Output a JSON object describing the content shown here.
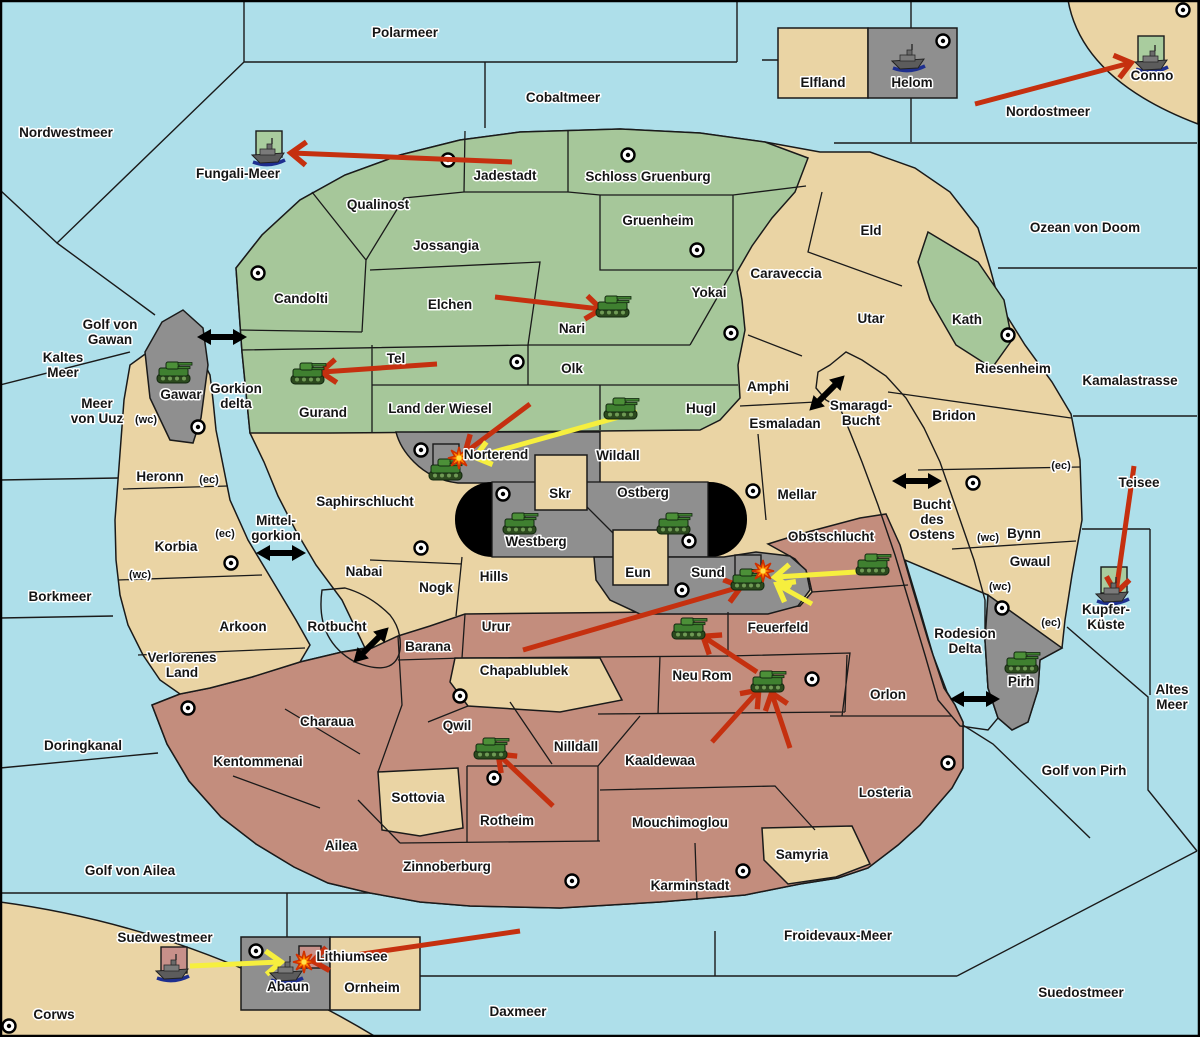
{
  "map": {
    "colors": {
      "sea": "#AEDFEA",
      "land_tan": "#EAD4A4",
      "land_green": "#A6C79A",
      "land_red": "#C38D7D",
      "land_gray": "#8F8F8F",
      "capsule_black": "#000000",
      "attack_red": "#C5300F",
      "attack_yellow": "#F6EF3E",
      "unit_square_green": "#A9CC9E",
      "unit_square_pink": "#C8908A"
    },
    "labels": [
      {
        "id": "polarmeer",
        "t": "Polarmeer",
        "x": 405,
        "y": 37
      },
      {
        "id": "cobaltmeer",
        "t": "Cobaltmeer",
        "x": 563,
        "y": 102
      },
      {
        "id": "nordwestmeer",
        "t": "Nordwestmeer",
        "x": 66,
        "y": 137
      },
      {
        "id": "fungali-meer",
        "t": "Fungali-Meer",
        "x": 238,
        "y": 178
      },
      {
        "id": "nordostmeer",
        "t": "Nordostmeer",
        "x": 1048,
        "y": 116
      },
      {
        "id": "ozean-von-doom",
        "t": "Ozean von Doom",
        "x": 1085,
        "y": 232
      },
      {
        "id": "kaltes-meer",
        "lines": [
          "Kaltes",
          "Meer"
        ],
        "x": 63,
        "y": 362
      },
      {
        "id": "meer-von-uuz",
        "lines": [
          "Meer",
          "von Uuz"
        ],
        "x": 97,
        "y": 408
      },
      {
        "id": "golf-von-gawan",
        "lines": [
          "Golf von",
          "Gawan"
        ],
        "x": 110,
        "y": 329
      },
      {
        "id": "gorkion-delta",
        "lines": [
          "Gorkion",
          "delta"
        ],
        "x": 236,
        "y": 393
      },
      {
        "id": "kamalastrasse",
        "t": "Kamalastrasse",
        "x": 1130,
        "y": 385
      },
      {
        "id": "smaragd-bucht",
        "lines": [
          "Smaragd-",
          "Bucht"
        ],
        "x": 861,
        "y": 410
      },
      {
        "id": "bucht-des-ostens",
        "lines": [
          "Bucht",
          "des",
          "Ostens"
        ],
        "x": 932,
        "y": 509
      },
      {
        "id": "teisee",
        "t": "Teisee",
        "x": 1139,
        "y": 487
      },
      {
        "id": "borkmeer",
        "t": "Borkmeer",
        "x": 60,
        "y": 601
      },
      {
        "id": "mittel-gorkion",
        "lines": [
          "Mittel-",
          "gorkion"
        ],
        "x": 276,
        "y": 525
      },
      {
        "id": "rotbucht",
        "t": "Rotbucht",
        "x": 337,
        "y": 631
      },
      {
        "id": "doringkanal",
        "t": "Doringkanal",
        "x": 83,
        "y": 750
      },
      {
        "id": "golf-von-ailea",
        "t": "Golf von Ailea",
        "x": 130,
        "y": 875
      },
      {
        "id": "suedwestmeer",
        "t": "Suedwestmeer",
        "x": 165,
        "y": 942
      },
      {
        "id": "corws",
        "t": "Corws",
        "x": 54,
        "y": 1019
      },
      {
        "id": "lithiumsee",
        "t": "Lithiumsee",
        "x": 352,
        "y": 961
      },
      {
        "id": "daxmeer",
        "t": "Daxmeer",
        "x": 518,
        "y": 1016
      },
      {
        "id": "froidevaux-meer",
        "t": "Froidevaux-Meer",
        "x": 838,
        "y": 940
      },
      {
        "id": "suedostmeer",
        "t": "Suedostmeer",
        "x": 1081,
        "y": 997
      },
      {
        "id": "golf-von-pirh",
        "t": "Golf von Pirh",
        "x": 1084,
        "y": 775
      },
      {
        "id": "altes-meer",
        "lines": [
          "Altes",
          "Meer"
        ],
        "x": 1172,
        "y": 694
      },
      {
        "id": "rodesion-delta",
        "lines": [
          "Rodesion",
          "Delta"
        ],
        "x": 965,
        "y": 638
      },
      {
        "id": "qualinost",
        "t": "Qualinost",
        "x": 378,
        "y": 209
      },
      {
        "id": "j adestadt",
        "t": "Jadestadt",
        "x": 505,
        "y": 180
      },
      {
        "id": "schloss-gruenburg",
        "t": "Schloss Gruenburg",
        "x": 648,
        "y": 181
      },
      {
        "id": "jossangia",
        "t": "Jossangia",
        "x": 446,
        "y": 250
      },
      {
        "id": "gruenheim",
        "t": "Gruenheim",
        "x": 658,
        "y": 225
      },
      {
        "id": "yokai",
        "t": "Yokai",
        "x": 709,
        "y": 297
      },
      {
        "id": "candolti",
        "t": "Candolti",
        "x": 301,
        "y": 303
      },
      {
        "id": "elchen",
        "t": "Elchen",
        "x": 450,
        "y": 309
      },
      {
        "id": "nari",
        "t": "Nari",
        "x": 572,
        "y": 333
      },
      {
        "id": "tel",
        "t": "Tel",
        "x": 396,
        "y": 363
      },
      {
        "id": "olk",
        "t": "Olk",
        "x": 572,
        "y": 373
      },
      {
        "id": "gurand",
        "t": "Gurand",
        "x": 323,
        "y": 417
      },
      {
        "id": "land-der-wiesel",
        "t": "Land der Wiesel",
        "x": 440,
        "y": 413
      },
      {
        "id": "hugl",
        "t": "Hugl",
        "x": 701,
        "y": 413
      },
      {
        "id": "amphi",
        "t": "Amphi",
        "x": 768,
        "y": 391
      },
      {
        "id": "esmaladan",
        "t": "Esmaladan",
        "x": 785,
        "y": 428
      },
      {
        "id": "eld",
        "t": "Eld",
        "x": 871,
        "y": 235
      },
      {
        "id": "utar",
        "t": "Utar",
        "x": 871,
        "y": 323
      },
      {
        "id": "kath",
        "t": "Kath",
        "x": 967,
        "y": 324
      },
      {
        "id": "caraveccia",
        "t": "Caraveccia",
        "x": 786,
        "y": 278
      },
      {
        "id": "riesenheim",
        "t": "Riesenheim",
        "x": 1013,
        "y": 373
      },
      {
        "id": "bridon",
        "t": "Bridon",
        "x": 954,
        "y": 420
      },
      {
        "id": "bynn",
        "t": "Bynn",
        "x": 1024,
        "y": 538
      },
      {
        "id": "gwaul",
        "t": "Gwaul",
        "x": 1030,
        "y": 566
      },
      {
        "id": "mellar",
        "t": "Mellar",
        "x": 797,
        "y": 499
      },
      {
        "id": "wildall",
        "t": "Wildall",
        "x": 618,
        "y": 460
      },
      {
        "id": "norterend",
        "t": "Norterend",
        "x": 496,
        "y": 459
      },
      {
        "id": "skr",
        "t": "Skr",
        "x": 560,
        "y": 498
      },
      {
        "id": "ostberg",
        "t": "Ostberg",
        "x": 643,
        "y": 497
      },
      {
        "id": "westberg",
        "t": "Westberg",
        "x": 536,
        "y": 546
      },
      {
        "id": "eun",
        "t": "Eun",
        "x": 638,
        "y": 577
      },
      {
        "id": "sund",
        "t": "Sund",
        "x": 708,
        "y": 577
      },
      {
        "id": "hills",
        "t": "Hills",
        "x": 494,
        "y": 581
      },
      {
        "id": "nogk",
        "t": "Nogk",
        "x": 436,
        "y": 592
      },
      {
        "id": "nabai",
        "t": "Nabai",
        "x": 364,
        "y": 576
      },
      {
        "id": "saphirschlucht",
        "t": "Saphirschlucht",
        "x": 365,
        "y": 506
      },
      {
        "id": "heronn",
        "t": "Heronn",
        "x": 160,
        "y": 481
      },
      {
        "id": "korbia",
        "t": "Korbia",
        "x": 176,
        "y": 551
      },
      {
        "id": "arkoon",
        "t": "Arkoon",
        "x": 243,
        "y": 631
      },
      {
        "id": "verlorenes-land",
        "lines": [
          "Verlorenes",
          "Land"
        ],
        "x": 182,
        "y": 662
      },
      {
        "id": "urur",
        "t": "Urur",
        "x": 496,
        "y": 631
      },
      {
        "id": "barana",
        "t": "Barana",
        "x": 428,
        "y": 651
      },
      {
        "id": "chapablublek",
        "t": "Chapablublek",
        "x": 524,
        "y": 675
      },
      {
        "id": "feuerfeld",
        "t": "Feuerfeld",
        "x": 778,
        "y": 632
      },
      {
        "id": "neu-rom",
        "t": "Neu Rom",
        "x": 702,
        "y": 680
      },
      {
        "id": "obstschlucht",
        "t": "Obstschlucht",
        "x": 831,
        "y": 541
      },
      {
        "id": "orlon",
        "t": "Orlon",
        "x": 888,
        "y": 699
      },
      {
        "id": "losteria",
        "t": "Losteria",
        "x": 885,
        "y": 797
      },
      {
        "id": "samyria",
        "t": "Samyria",
        "x": 802,
        "y": 859
      },
      {
        "id": "karminstadt",
        "t": "Karminstadt",
        "x": 690,
        "y": 890
      },
      {
        "id": "zinnoberburg",
        "t": "Zinnoberburg",
        "x": 447,
        "y": 871
      },
      {
        "id": "ailea",
        "t": "Ailea",
        "x": 341,
        "y": 850
      },
      {
        "id": "charaua",
        "t": "Charaua",
        "x": 327,
        "y": 726
      },
      {
        "id": "kentommenai",
        "t": "Kentommenai",
        "x": 258,
        "y": 766
      },
      {
        "id": "sottovia",
        "t": "Sottovia",
        "x": 418,
        "y": 802
      },
      {
        "id": "qwil",
        "t": "Qwil",
        "x": 457,
        "y": 730
      },
      {
        "id": "nilldall",
        "t": "Nilldall",
        "x": 576,
        "y": 751
      },
      {
        "id": "kaaldewaa",
        "t": "Kaaldewaa",
        "x": 660,
        "y": 765
      },
      {
        "id": "rotheim",
        "t": "Rotheim",
        "x": 507,
        "y": 825
      },
      {
        "id": "mouchimoglou",
        "t": "Mouchimoglou",
        "x": 680,
        "y": 827
      },
      {
        "id": "elfland",
        "t": "Elfland",
        "x": 823,
        "y": 87
      },
      {
        "id": "helom",
        "t": "Helom",
        "x": 912,
        "y": 87
      },
      {
        "id": "conno",
        "t": "Conno",
        "x": 1152,
        "y": 80
      },
      {
        "id": "abaun",
        "t": "Abaun",
        "x": 288,
        "y": 991
      },
      {
        "id": "ornheim",
        "t": "Ornheim",
        "x": 372,
        "y": 992
      },
      {
        "id": "pirh",
        "t": "Pirh",
        "x": 1021,
        "y": 686
      },
      {
        "id": "kupfer-kueste",
        "lines": [
          "Kupfer-",
          "Küste"
        ],
        "x": 1106,
        "y": 614
      },
      {
        "id": "gawar",
        "t": "Gawar",
        "x": 181,
        "y": 399
      }
    ],
    "badges": [
      {
        "t": "(wc)",
        "x": 146,
        "y": 419
      },
      {
        "t": "(ec)",
        "x": 209,
        "y": 479
      },
      {
        "t": "(ec)",
        "x": 225,
        "y": 533
      },
      {
        "t": "(wc)",
        "x": 140,
        "y": 574
      },
      {
        "t": "(wc)",
        "x": 988,
        "y": 537
      },
      {
        "t": "(ec)",
        "x": 1061,
        "y": 465
      },
      {
        "t": "(wc)",
        "x": 1000,
        "y": 586
      },
      {
        "t": "(ec)",
        "x": 1051,
        "y": 622
      }
    ],
    "capitals": [
      {
        "x": 258,
        "y": 273
      },
      {
        "x": 448,
        "y": 160
      },
      {
        "x": 628,
        "y": 155
      },
      {
        "x": 697,
        "y": 250
      },
      {
        "x": 731,
        "y": 333
      },
      {
        "x": 943,
        "y": 41
      },
      {
        "x": 1183,
        "y": 10
      },
      {
        "x": 1008,
        "y": 335
      },
      {
        "x": 198,
        "y": 427
      },
      {
        "x": 231,
        "y": 563
      },
      {
        "x": 517,
        "y": 362
      },
      {
        "x": 421,
        "y": 450
      },
      {
        "x": 503,
        "y": 494
      },
      {
        "x": 689,
        "y": 541
      },
      {
        "x": 753,
        "y": 491
      },
      {
        "x": 973,
        "y": 483
      },
      {
        "x": 1002,
        "y": 608
      },
      {
        "x": 682,
        "y": 590
      },
      {
        "x": 812,
        "y": 679
      },
      {
        "x": 948,
        "y": 763
      },
      {
        "x": 188,
        "y": 708
      },
      {
        "x": 460,
        "y": 696
      },
      {
        "x": 494,
        "y": 778
      },
      {
        "x": 572,
        "y": 881
      },
      {
        "x": 743,
        "y": 871
      },
      {
        "x": 9,
        "y": 1026
      },
      {
        "x": 256,
        "y": 951
      },
      {
        "x": 421,
        "y": 548
      }
    ],
    "units": [
      {
        "type": "tank",
        "region": "nari",
        "x": 613,
        "y": 307
      },
      {
        "type": "tank",
        "region": "gurand",
        "x": 308,
        "y": 374
      },
      {
        "type": "tank",
        "region": "gawar",
        "x": 174,
        "y": 373
      },
      {
        "type": "tank",
        "region": "hugl",
        "x": 621,
        "y": 409
      },
      {
        "type": "tank",
        "region": "norterend",
        "x": 446,
        "y": 470
      },
      {
        "type": "tank",
        "region": "westberg",
        "x": 520,
        "y": 524
      },
      {
        "type": "tank",
        "region": "ostberg",
        "x": 674,
        "y": 524
      },
      {
        "type": "tank",
        "region": "sund",
        "x": 748,
        "y": 580
      },
      {
        "type": "tank",
        "region": "obstschlucht",
        "x": 873,
        "y": 565
      },
      {
        "type": "tank",
        "region": "feuerfeld",
        "x": 689,
        "y": 629
      },
      {
        "type": "tank",
        "region": "neu-rom",
        "x": 768,
        "y": 682
      },
      {
        "type": "tank",
        "region": "qwil",
        "x": 491,
        "y": 749
      },
      {
        "type": "tank",
        "region": "pirh",
        "x": 1022,
        "y": 663
      },
      {
        "type": "ship",
        "region": "fungali-meer",
        "x": 269,
        "y": 153
      },
      {
        "type": "ship",
        "region": "helom",
        "x": 909,
        "y": 59
      },
      {
        "type": "ship",
        "region": "conno",
        "x": 1152,
        "y": 60
      },
      {
        "type": "ship",
        "region": "kupfer-kueste",
        "x": 1113,
        "y": 592
      },
      {
        "type": "ship",
        "region": "suedwestmeer",
        "x": 173,
        "y": 969
      },
      {
        "type": "ship",
        "region": "abaun",
        "x": 287,
        "y": 971
      }
    ],
    "unit_squares": [
      {
        "x": 256,
        "y": 131,
        "s": 26,
        "fill": "green"
      },
      {
        "x": 1138,
        "y": 36,
        "s": 26,
        "fill": "green"
      },
      {
        "x": 1101,
        "y": 567,
        "s": 26,
        "fill": "green"
      },
      {
        "x": 161,
        "y": 947,
        "s": 26,
        "fill": "pink"
      },
      {
        "x": 299,
        "y": 946,
        "s": 22,
        "fill": "pink"
      },
      {
        "x": 433,
        "y": 444,
        "s": 26,
        "fill": "none"
      },
      {
        "x": 735,
        "y": 555,
        "s": 26,
        "fill": "none"
      }
    ],
    "explosions": [
      {
        "x": 459,
        "y": 458
      },
      {
        "x": 763,
        "y": 571
      },
      {
        "x": 304,
        "y": 962
      }
    ],
    "straits": [
      {
        "x": 222,
        "y": 337,
        "r": 0
      },
      {
        "x": 281,
        "y": 553,
        "r": 0
      },
      {
        "x": 371,
        "y": 645,
        "r": -45
      },
      {
        "x": 827,
        "y": 393,
        "r": -45
      },
      {
        "x": 917,
        "y": 481,
        "r": 0
      },
      {
        "x": 975,
        "y": 699,
        "r": 0
      }
    ],
    "attacks": [
      {
        "c": "red",
        "x1": 512,
        "y1": 162,
        "x2": 292,
        "y2": 153
      },
      {
        "c": "red",
        "x1": 975,
        "y1": 104,
        "x2": 1130,
        "y2": 63
      },
      {
        "c": "red",
        "x1": 495,
        "y1": 297,
        "x2": 600,
        "y2": 309
      },
      {
        "c": "red",
        "x1": 437,
        "y1": 364,
        "x2": 322,
        "y2": 372
      },
      {
        "c": "red",
        "x1": 530,
        "y1": 404,
        "x2": 466,
        "y2": 452
      },
      {
        "c": "red",
        "x1": 523,
        "y1": 650,
        "x2": 740,
        "y2": 587
      },
      {
        "c": "red",
        "x1": 757,
        "y1": 672,
        "x2": 704,
        "y2": 637
      },
      {
        "c": "red",
        "x1": 712,
        "y1": 742,
        "x2": 758,
        "y2": 691
      },
      {
        "c": "red",
        "x1": 790,
        "y1": 748,
        "x2": 772,
        "y2": 694
      },
      {
        "c": "red",
        "x1": 553,
        "y1": 806,
        "x2": 499,
        "y2": 755
      },
      {
        "c": "red",
        "x1": 1134,
        "y1": 466,
        "x2": 1116,
        "y2": 592
      },
      {
        "c": "red",
        "x1": 520,
        "y1": 931,
        "x2": 314,
        "y2": 961
      },
      {
        "c": "yellow",
        "x1": 637,
        "y1": 412,
        "x2": 476,
        "y2": 457
      },
      {
        "c": "yellow",
        "x1": 856,
        "y1": 572,
        "x2": 776,
        "y2": 577
      },
      {
        "c": "yellow",
        "x1": 812,
        "y1": 604,
        "x2": 778,
        "y2": 585
      },
      {
        "c": "yellow",
        "x1": 190,
        "y1": 966,
        "x2": 280,
        "y2": 962
      }
    ]
  }
}
